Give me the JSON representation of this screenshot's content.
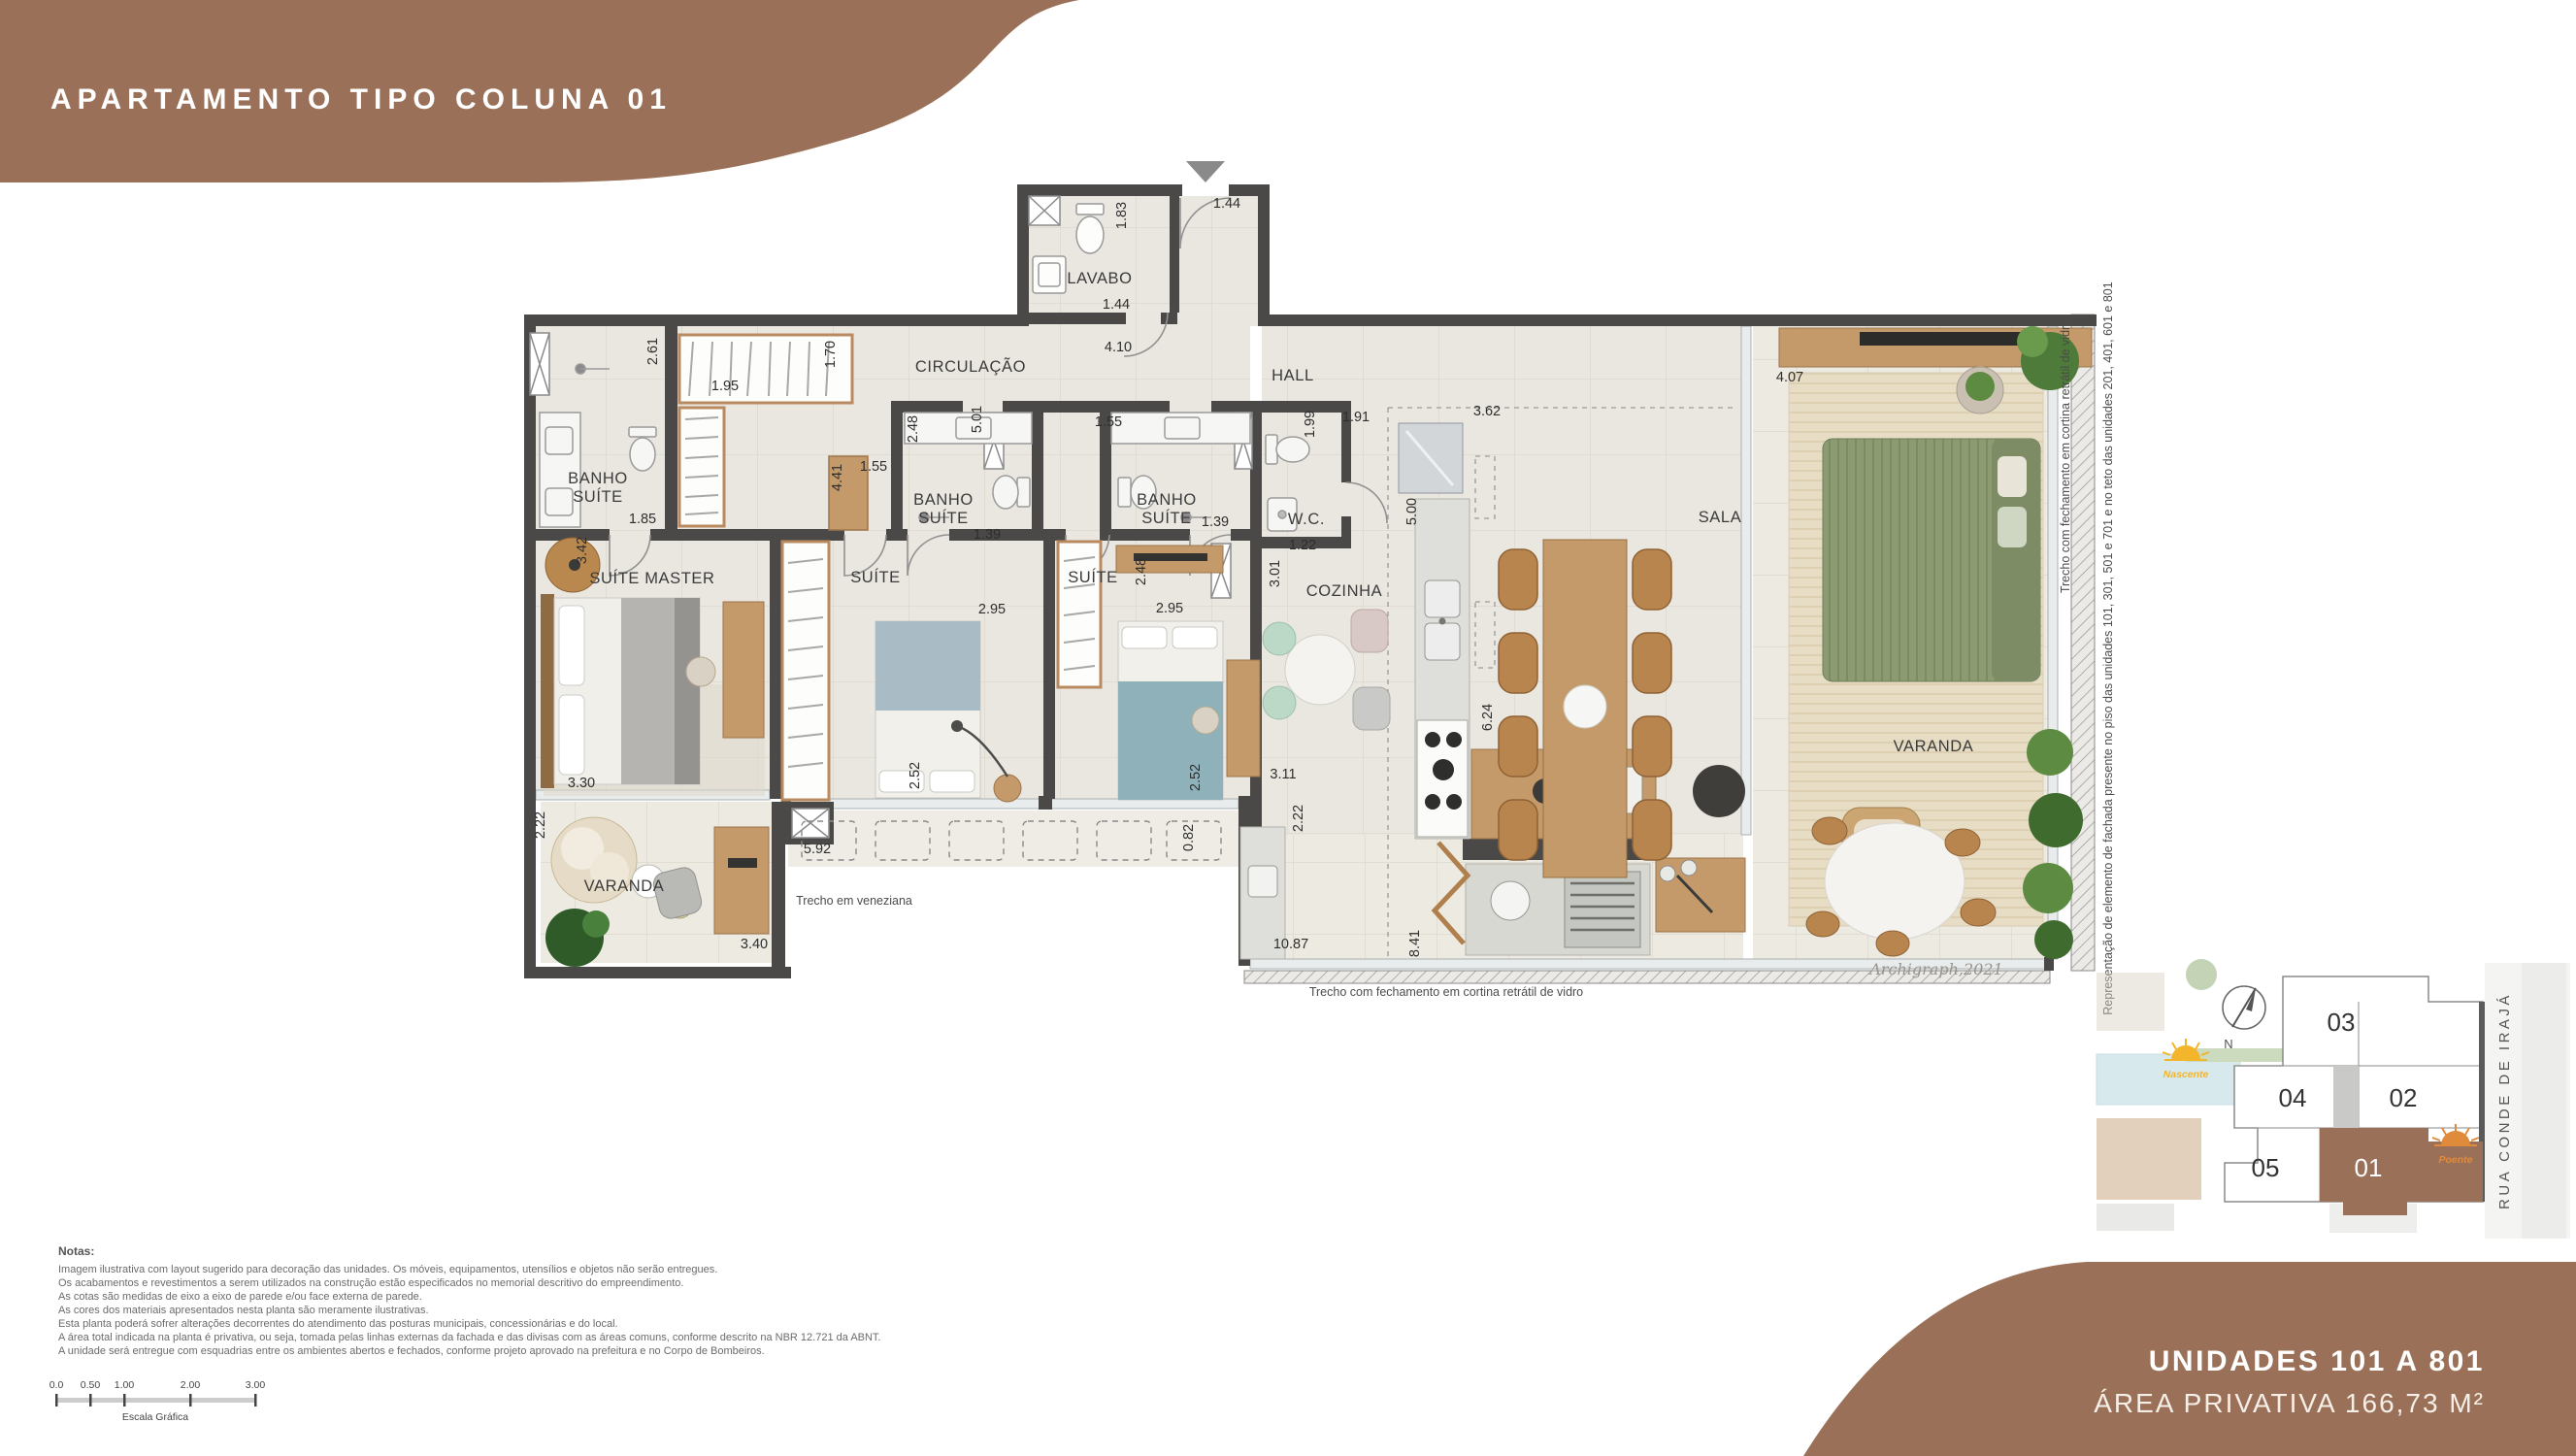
{
  "title": "APARTAMENTO TIPO COLUNA 01",
  "footer": {
    "line1": "UNIDADES 101 A 801",
    "line2": "ÁREA PRIVATIVA 166,73 M²"
  },
  "notes": {
    "heading": "Notas:",
    "lines": [
      "Imagem ilustrativa com layout sugerido para decoração das unidades. Os móveis, equipamentos, utensílios e objetos não serão entregues.",
      "Os acabamentos e revestimentos a serem utilizados na construção estão especificados no memorial descritivo do empreendimento.",
      "As cotas são medidas de eixo a eixo de parede e/ou face externa de parede.",
      "As cores dos materiais apresentados nesta planta são meramente ilustrativas.",
      "Esta planta poderá sofrer alterações decorrentes do atendimento das posturas municipais, concessionárias e do local.",
      "A área total indicada na planta é privativa, ou seja, tomada pelas linhas externas da fachada e das divisas com as áreas comuns, conforme descrito na NBR 12.721 da ABNT.",
      "A unidade será entregue com esquadrias entre os ambientes abertos e fechados, conforme projeto aprovado na prefeitura e no Corpo de Bombeiros."
    ]
  },
  "scale": {
    "ticks": [
      "0.0",
      "0.50",
      "1.00",
      "2.00",
      "3.00"
    ],
    "caption": "Escala Gráfica"
  },
  "plan": {
    "labels": [
      {
        "t": "LAVABO"
      },
      {
        "t": "CIRCULAÇÃO"
      },
      {
        "t": "HALL"
      },
      {
        "t": "BANHO"
      },
      {
        "t": "SUÍTE"
      },
      {
        "t": "SUÍTE MASTER"
      },
      {
        "t": "SUÍTE"
      },
      {
        "t": "BANHO"
      },
      {
        "t": "SUÍTE"
      },
      {
        "t": "SUÍTE"
      },
      {
        "t": "BANHO"
      },
      {
        "t": "SUÍTE"
      },
      {
        "t": "W.C."
      },
      {
        "t": "COZINHA"
      },
      {
        "t": "SALA"
      },
      {
        "t": "VARANDA"
      },
      {
        "t": "VARANDA"
      }
    ],
    "dims": [
      {
        "t": "1.83"
      },
      {
        "t": "1.44"
      },
      {
        "t": "1.44"
      },
      {
        "t": "4.10"
      },
      {
        "t": "2.61"
      },
      {
        "t": "1.95"
      },
      {
        "t": "1.70"
      },
      {
        "t": "1.85"
      },
      {
        "t": "3.42"
      },
      {
        "t": "4.41"
      },
      {
        "t": "1.55"
      },
      {
        "t": "5.01"
      },
      {
        "t": "1.55"
      },
      {
        "t": "2.48"
      },
      {
        "t": "1.39"
      },
      {
        "t": "2.48"
      },
      {
        "t": "1.39"
      },
      {
        "t": "1.99"
      },
      {
        "t": "1.22"
      },
      {
        "t": "1.91"
      },
      {
        "t": "3.62"
      },
      {
        "t": "5.00"
      },
      {
        "t": "3.01"
      },
      {
        "t": "2.95"
      },
      {
        "t": "2.95"
      },
      {
        "t": "2.52"
      },
      {
        "t": "2.52"
      },
      {
        "t": "0.82"
      },
      {
        "t": "6.24"
      },
      {
        "t": "3.11"
      },
      {
        "t": "2.22"
      },
      {
        "t": "3.30"
      },
      {
        "t": "2.22"
      },
      {
        "t": "5.92"
      },
      {
        "t": "3.40"
      },
      {
        "t": "4.07"
      },
      {
        "t": "10.87"
      },
      {
        "t": "8.41"
      }
    ],
    "annotations": {
      "veneziana": "Trecho em veneziana",
      "cortina_bottom": "Trecho com fechamento em cortina retrátil de vidro",
      "cortina_right": "Trecho com fechamento em cortina retrátil de vidro",
      "fachada": "Representação de elemento de fachada presente no piso das unidades 101, 301, 501 e 701 e no teto das unidades 201, 401, 601 e 801",
      "signature": "Archigraph,2021"
    }
  },
  "keyplan": {
    "units": [
      {
        "n": "03"
      },
      {
        "n": "04"
      },
      {
        "n": "02"
      },
      {
        "n": "05"
      },
      {
        "n": "01"
      }
    ],
    "street": "RUA CONDE DE IRAJÁ",
    "compass": "N",
    "nascente": "Nascente",
    "poente": "Poente"
  },
  "colors": {
    "accent": "#9a7158",
    "wall": "#4a4947",
    "nascente": "#f2b52b",
    "poente": "#e08a3c"
  }
}
